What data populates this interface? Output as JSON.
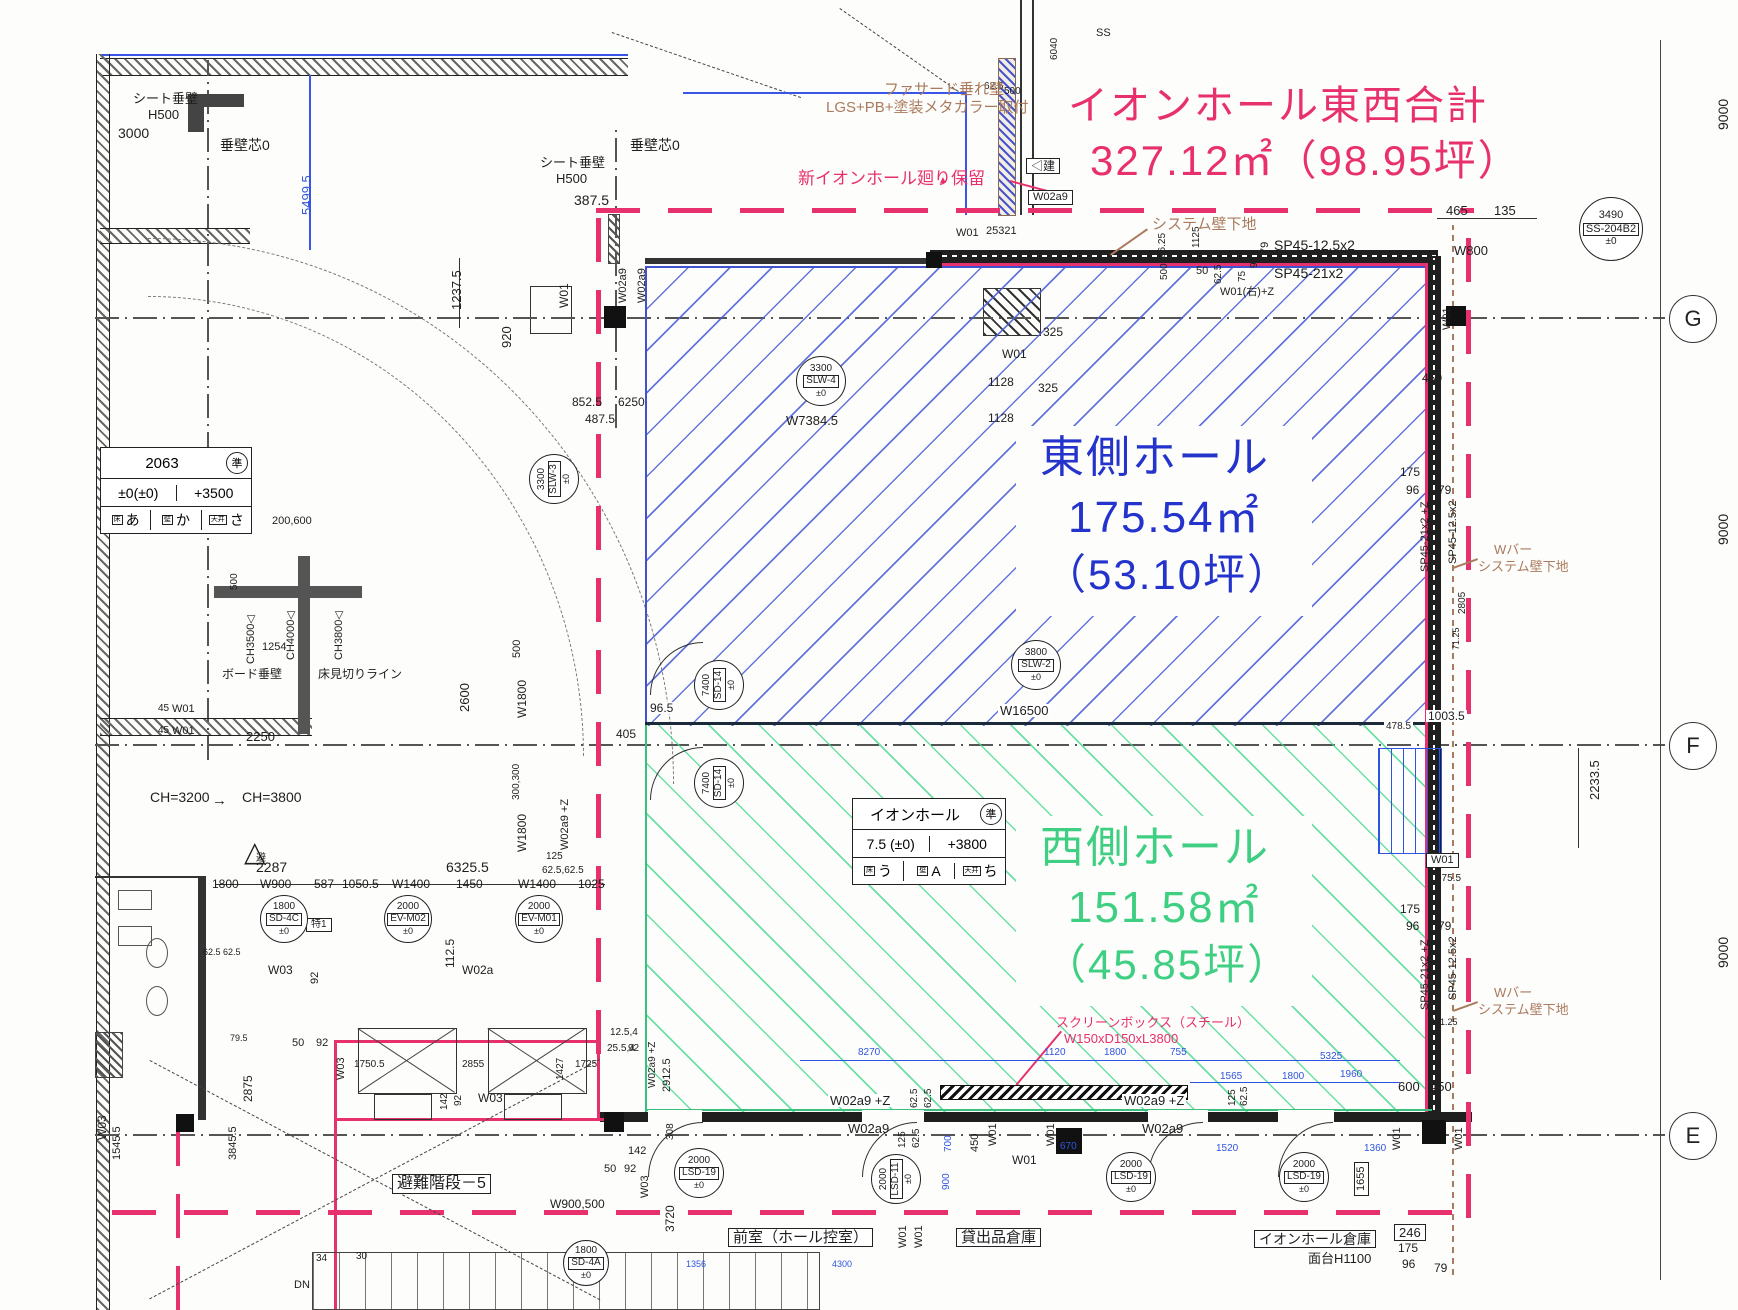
{
  "colors": {
    "boundary_pink": "#e8306e",
    "east_blue": "#2433cc",
    "west_green": "#3ecf82",
    "note_brown": "#aa7a5e",
    "dim_blue": "#2f55e0"
  },
  "title": {
    "line1": "イオンホール東西合計",
    "line2": "327.12㎡（98.95坪）"
  },
  "east_hall": {
    "name": "東側ホール",
    "area": "175.54㎡",
    "tsubo": "（53.10坪）"
  },
  "west_hall": {
    "name": "西側ホール",
    "area": "151.58㎡",
    "tsubo": "（45.85坪）"
  },
  "grid": {
    "marks": [
      [
        "G",
        318
      ],
      [
        "F",
        745
      ],
      [
        "E",
        1135
      ]
    ],
    "span_label": "9000"
  },
  "room_tags": [
    [
      820,
      380,
      24,
      "3300",
      "SLW-4",
      "±0",
      0
    ],
    [
      553,
      478,
      24,
      "3300",
      "SLW-3",
      "±0",
      -90
    ],
    [
      1035,
      664,
      24,
      "3800",
      "SLW-2",
      "±0",
      0
    ],
    [
      718,
      684,
      24,
      "7400",
      "SD-14",
      "±0",
      -90
    ],
    [
      718,
      782,
      24,
      "7400",
      "SD-14",
      "±0",
      -90
    ],
    [
      283,
      918,
      23,
      "1800",
      "SD-4C",
      "±0",
      0
    ],
    [
      407,
      918,
      23,
      "2000",
      "EV-M02",
      "±0",
      0
    ],
    [
      538,
      918,
      23,
      "2000",
      "EV-M01",
      "±0",
      0
    ],
    [
      698,
      1172,
      24,
      "2000",
      "LSD-19",
      "±0",
      0
    ],
    [
      895,
      1178,
      24,
      "2000",
      "LSD-11",
      "±0",
      -90
    ],
    [
      1130,
      1176,
      24,
      "2000",
      "LSD-19",
      "±0",
      0
    ],
    [
      1303,
      1176,
      24,
      "2000",
      "LSD-19",
      "±0",
      0
    ],
    [
      585,
      1262,
      22,
      "1800",
      "SD-4A",
      "±0",
      0
    ],
    [
      1610,
      228,
      31,
      "3490",
      "SS-204B2",
      "±0",
      0
    ]
  ],
  "stamp_tables": [
    {
      "x": 100,
      "y": 447,
      "w": 150,
      "title": "2063",
      "stamp": "準",
      "levels": [
        "±0(±0)",
        "+3500"
      ],
      "finishes": [
        [
          "床",
          "あ"
        ],
        [
          "壁",
          "か"
        ],
        [
          "天井",
          "さ"
        ]
      ]
    },
    {
      "x": 852,
      "y": 798,
      "w": 152,
      "title": "イオンホール",
      "stamp": "準",
      "levels": [
        "7.5 (±0)",
        "+3800"
      ],
      "finishes": [
        [
          "床",
          "う"
        ],
        [
          "壁",
          "A"
        ],
        [
          "天井",
          "ち"
        ]
      ]
    }
  ],
  "labels": [
    [
      "シート垂壁",
      133,
      92,
      13
    ],
    [
      "H500",
      148,
      108,
      13
    ],
    [
      "3000",
      118,
      126,
      14
    ],
    [
      "垂壁芯0",
      220,
      138,
      14
    ],
    [
      "5499.5",
      300,
      215,
      13,
      "b",
      -90
    ],
    [
      "シート垂壁",
      540,
      156,
      13
    ],
    [
      "H500",
      556,
      172,
      13
    ],
    [
      "垂壁芯0",
      630,
      138,
      14
    ],
    [
      "387.5",
      574,
      193,
      14
    ],
    [
      "1237.5",
      450,
      310,
      13,
      "k",
      -90
    ],
    [
      "920",
      500,
      348,
      13,
      "k",
      -90
    ],
    [
      "W01",
      558,
      308,
      12,
      "k",
      -90
    ],
    [
      "W02a9",
      618,
      303,
      11,
      "k",
      -90
    ],
    [
      "W02a9",
      637,
      303,
      11,
      "k",
      -90
    ],
    [
      "852.5",
      572,
      396,
      12
    ],
    [
      "6250",
      618,
      396,
      12
    ],
    [
      "487.5",
      585,
      413,
      12
    ],
    [
      "W7384.5",
      786,
      414,
      13
    ],
    [
      "1128",
      988,
      376,
      12
    ],
    [
      "1128",
      988,
      412,
      12
    ],
    [
      "325",
      1043,
      326,
      12
    ],
    [
      "325",
      1038,
      382,
      12
    ],
    [
      "W01",
      1002,
      348,
      12
    ],
    [
      "W01",
      956,
      228,
      11
    ],
    [
      "25321",
      986,
      226,
      11
    ],
    [
      "62.5",
      984,
      82,
      10
    ],
    [
      "500",
      1004,
      87,
      10
    ],
    [
      "6040",
      1050,
      60,
      10,
      "k",
      -90
    ],
    [
      "SS",
      1096,
      28,
      11
    ],
    [
      "1125",
      1192,
      248,
      10,
      "k",
      -90
    ],
    [
      "96.25",
      1158,
      258,
      10,
      "k",
      -90
    ],
    [
      "500",
      1160,
      280,
      10,
      "k",
      -90
    ],
    [
      "50",
      1196,
      266,
      11
    ],
    [
      "62.5",
      1214,
      284,
      10,
      "k",
      -90
    ],
    [
      "75",
      1238,
      282,
      10,
      "k",
      -90
    ],
    [
      "96",
      1250,
      268,
      10,
      "k",
      -90
    ],
    [
      "79",
      1260,
      254,
      11,
      "k",
      -90
    ],
    [
      "SP45-12.5x2",
      1274,
      238,
      14
    ],
    [
      "SP45-21x2",
      1274,
      266,
      14
    ],
    [
      "W01(右)+Z",
      1220,
      287,
      11
    ],
    [
      "465",
      1446,
      204,
      13
    ],
    [
      "135",
      1494,
      204,
      13
    ],
    [
      "W800",
      1454,
      244,
      13
    ],
    [
      "W01",
      1442,
      330,
      11,
      "k",
      -90
    ],
    [
      "450",
      1422,
      372,
      12
    ],
    [
      "175",
      1400,
      466,
      12
    ],
    [
      "96",
      1406,
      484,
      12
    ],
    [
      "79",
      1438,
      484,
      12
    ],
    [
      "SP45-21x2 +Z",
      1420,
      572,
      11,
      "k",
      -90
    ],
    [
      "SP45-12.5x2",
      1448,
      564,
      11,
      "k",
      -90
    ],
    [
      "2805",
      1458,
      614,
      10,
      "k",
      -90
    ],
    [
      "71.25",
      1452,
      650,
      9,
      "k",
      -90
    ],
    [
      "1003.5",
      1426,
      710,
      12,
      "k",
      0,
      "bg"
    ],
    [
      "478.5",
      1384,
      722,
      10,
      "k",
      0,
      "bg"
    ],
    [
      "2233.5",
      1588,
      800,
      13,
      "k",
      -90
    ],
    [
      "W01",
      1426,
      853,
      11,
      "k",
      0,
      "box"
    ],
    [
      "975.5",
      1436,
      874,
      10
    ],
    [
      "175",
      1400,
      903,
      12
    ],
    [
      "96",
      1406,
      920,
      12
    ],
    [
      "79",
      1438,
      920,
      12
    ],
    [
      "SP45-21x2 +Z",
      1420,
      1010,
      11,
      "k",
      -90
    ],
    [
      "SP45-12.5x2",
      1448,
      1000,
      11,
      "k",
      -90
    ],
    [
      "471.25",
      1430,
      1018,
      9
    ],
    [
      "W16500",
      998,
      704,
      13,
      "k",
      0,
      "bg"
    ],
    [
      "96.5",
      648,
      702,
      12,
      "k",
      0,
      "bg"
    ],
    [
      "405",
      616,
      728,
      12
    ],
    [
      "2250",
      246,
      730,
      13
    ],
    [
      "45",
      158,
      704,
      10
    ],
    [
      "45",
      158,
      726,
      10
    ],
    [
      "W01",
      172,
      704,
      11
    ],
    [
      "W01",
      172,
      726,
      11
    ],
    [
      "200,600",
      272,
      516,
      11
    ],
    [
      "CH3500◁",
      246,
      664,
      11,
      "k",
      -90
    ],
    [
      "CH4000◁",
      286,
      660,
      11,
      "k",
      -90
    ],
    [
      "CH3800◁",
      334,
      660,
      11,
      "k",
      -90
    ],
    [
      "500",
      230,
      590,
      10,
      "k",
      -90
    ],
    [
      "1254",
      262,
      642,
      11
    ],
    [
      "ボード垂壁",
      222,
      668,
      12
    ],
    [
      "床見切りライン",
      318,
      668,
      12
    ],
    [
      "2600",
      458,
      712,
      13,
      "k",
      -90
    ],
    [
      "500",
      512,
      658,
      11,
      "k",
      -90
    ],
    [
      "W1800",
      516,
      718,
      12,
      "k",
      -90
    ],
    [
      "300,300",
      512,
      800,
      10,
      "k",
      -90
    ],
    [
      "W1800",
      516,
      852,
      12,
      "k",
      -90
    ],
    [
      "CH=3200",
      150,
      790,
      14
    ],
    [
      "CH=3800",
      242,
      790,
      14
    ],
    [
      "→",
      212,
      793,
      15
    ],
    [
      "2287",
      256,
      860,
      14
    ],
    [
      "6325.5",
      446,
      860,
      14
    ],
    [
      "1800",
      212,
      878,
      12
    ],
    [
      "W900",
      260,
      878,
      12
    ],
    [
      "587",
      314,
      878,
      12
    ],
    [
      "1050.5",
      342,
      878,
      12
    ],
    [
      "W1400",
      392,
      878,
      12
    ],
    [
      "1450",
      456,
      878,
      12
    ],
    [
      "W1400",
      518,
      878,
      12
    ],
    [
      "1025",
      578,
      878,
      12
    ],
    [
      "W02a9 +Z",
      560,
      850,
      11,
      "k",
      -90
    ],
    [
      "125",
      546,
      852,
      10
    ],
    [
      "62.5,62.5",
      542,
      866,
      10
    ],
    [
      "特1",
      306,
      918,
      10,
      "k",
      0,
      "box"
    ],
    [
      "W03",
      268,
      964,
      12
    ],
    [
      "92",
      310,
      984,
      11,
      "k",
      -90
    ],
    [
      "112.5",
      444,
      968,
      12,
      "k",
      -90
    ],
    [
      "W02a",
      462,
      964,
      12
    ],
    [
      "62.5 62.5",
      203,
      948,
      9
    ],
    [
      "12.5,4",
      610,
      1028,
      10
    ],
    [
      "25.5,4",
      607,
      1044,
      10
    ],
    [
      "92",
      628,
      1044,
      10
    ],
    [
      "2912.5",
      662,
      1092,
      11,
      "k",
      -90
    ],
    [
      "W02a9 +Z",
      648,
      1088,
      10,
      "k",
      -90
    ],
    [
      "2875",
      242,
      1102,
      12,
      "k",
      -90
    ],
    [
      "79.5",
      230,
      1034,
      9
    ],
    [
      "W03",
      96,
      1140,
      12,
      "k",
      -90
    ],
    [
      "1750.5",
      354,
      1060,
      10
    ],
    [
      "2855",
      462,
      1060,
      10
    ],
    [
      "1427",
      556,
      1080,
      10,
      "k",
      -90
    ],
    [
      "1725",
      575,
      1060,
      10
    ],
    [
      "142",
      440,
      1110,
      10,
      "k",
      -90
    ],
    [
      "92",
      454,
      1106,
      10,
      "k",
      -90
    ],
    [
      "W03",
      478,
      1092,
      12
    ],
    [
      "50",
      292,
      1038,
      11
    ],
    [
      "92",
      316,
      1038,
      11
    ],
    [
      "W03",
      336,
      1080,
      11,
      "k",
      -90
    ],
    [
      "142",
      628,
      1146,
      11
    ],
    [
      "50",
      604,
      1164,
      11
    ],
    [
      "92",
      624,
      1164,
      11
    ],
    [
      "W03",
      640,
      1198,
      11,
      "k",
      -90
    ],
    [
      "308",
      666,
      1140,
      10,
      "k",
      -90
    ],
    [
      "3845.5",
      228,
      1160,
      11,
      "k",
      -90
    ],
    [
      "1545.5",
      112,
      1160,
      11,
      "k",
      -90
    ],
    [
      "34",
      316,
      1254,
      10
    ],
    [
      "30",
      356,
      1252,
      10
    ],
    [
      "DN",
      294,
      1280,
      11
    ],
    [
      "W900,500",
      550,
      1198,
      12
    ],
    [
      "3720",
      664,
      1232,
      12,
      "k",
      -90
    ],
    [
      "W02a9 +Z",
      828,
      1094,
      13,
      "k",
      0,
      "bg"
    ],
    [
      "62.5",
      910,
      1108,
      10,
      "k",
      -90
    ],
    [
      "62.5",
      924,
      1108,
      10,
      "k",
      -90
    ],
    [
      "W02a9",
      848,
      1122,
      13
    ],
    [
      "125",
      898,
      1148,
      10,
      "k",
      -90
    ],
    [
      "62.5",
      912,
      1148,
      10,
      "k",
      -90
    ],
    [
      "W02a9 +Z",
      1122,
      1094,
      13,
      "k",
      0,
      "bg"
    ],
    [
      "W02a9",
      1142,
      1122,
      13
    ],
    [
      "125",
      1228,
      1106,
      10,
      "k",
      -90
    ],
    [
      "62.5",
      1240,
      1106,
      10,
      "k",
      -90
    ],
    [
      "8270",
      858,
      1048,
      10,
      "b"
    ],
    [
      "1120",
      1044,
      1048,
      10,
      "b"
    ],
    [
      "1800",
      1104,
      1048,
      10,
      "b"
    ],
    [
      "755",
      1170,
      1048,
      10,
      "b"
    ],
    [
      "5325",
      1320,
      1052,
      10,
      "b"
    ],
    [
      "1565",
      1220,
      1072,
      10,
      "b"
    ],
    [
      "1800",
      1282,
      1072,
      10,
      "b"
    ],
    [
      "1960",
      1340,
      1070,
      10,
      "b"
    ],
    [
      "1520",
      1216,
      1144,
      10,
      "b"
    ],
    [
      "1360",
      1364,
      1144,
      10,
      "b"
    ],
    [
      "670",
      1060,
      1142,
      10,
      "b"
    ],
    [
      "700",
      944,
      1152,
      10,
      "b",
      -90
    ],
    [
      "900",
      942,
      1190,
      10,
      "b",
      -90
    ],
    [
      "1356",
      686,
      1260,
      9,
      "b"
    ],
    [
      "4300",
      832,
      1260,
      9,
      "b"
    ],
    [
      "600",
      1398,
      1080,
      13
    ],
    [
      "450",
      1430,
      1080,
      13
    ],
    [
      "W01",
      1392,
      1150,
      11,
      "k",
      -90
    ],
    [
      "W01",
      1454,
      1150,
      11,
      "k",
      -90
    ],
    [
      "450",
      970,
      1152,
      11,
      "k",
      -90
    ],
    [
      "W01",
      988,
      1146,
      11,
      "k",
      -90
    ],
    [
      "W01",
      1046,
      1146,
      11,
      "k",
      -90
    ],
    [
      "W01",
      1010,
      1154,
      12,
      "k",
      0,
      "bg"
    ],
    [
      "1655",
      1354,
      1196,
      11,
      "k",
      -90,
      "box"
    ],
    [
      "246",
      1394,
      1224,
      13,
      "k",
      0,
      "box"
    ],
    [
      "175",
      1398,
      1242,
      12
    ],
    [
      "96",
      1402,
      1258,
      12
    ],
    [
      "79",
      1434,
      1262,
      12
    ],
    [
      "スクリーンボックス（スチール）",
      1056,
      1016,
      13,
      "m"
    ],
    [
      "W150xD150xL3800",
      1064,
      1032,
      13,
      "m"
    ],
    [
      "前室（ホール控室）",
      728,
      1228,
      15,
      "k",
      0,
      "box"
    ],
    [
      "貸出品倉庫",
      956,
      1228,
      15,
      "k",
      0,
      "box"
    ],
    [
      "イオンホール倉庫",
      1254,
      1230,
      14,
      "k",
      0,
      "box"
    ],
    [
      "面台H1100",
      1308,
      1252,
      13
    ],
    [
      "W01",
      898,
      1248,
      11,
      "k",
      -90
    ],
    [
      "W01",
      914,
      1248,
      11,
      "k",
      -90
    ],
    [
      "避難階段－5",
      392,
      1174,
      16,
      "k",
      0,
      "box"
    ],
    [
      "ファサード垂れ壁",
      884,
      82,
      15,
      "br"
    ],
    [
      "LGS+PB+塗装メタカラー取付",
      826,
      100,
      15,
      "br"
    ],
    [
      "システム壁下地",
      1152,
      217,
      15,
      "br"
    ],
    [
      "Wバー",
      1494,
      543,
      13,
      "br"
    ],
    [
      "システム壁下地",
      1478,
      560,
      13,
      "br"
    ],
    [
      "Wバー",
      1494,
      986,
      13,
      "br"
    ],
    [
      "システム壁下地",
      1478,
      1003,
      13,
      "br"
    ],
    [
      "新イオンホール廻り保留",
      798,
      170,
      17,
      "m"
    ],
    [
      "▲",
      938,
      176,
      10,
      "m"
    ],
    [
      "△",
      244,
      838,
      28
    ],
    [
      "避",
      256,
      854,
      10
    ],
    [
      "9000",
      1716,
      130,
      14,
      "k",
      -90
    ],
    [
      "9000",
      1716,
      545,
      14,
      "k",
      -90
    ],
    [
      "9000",
      1716,
      968,
      14,
      "k",
      -90
    ],
    [
      "◁建",
      1026,
      158,
      12,
      "k",
      0,
      "box"
    ],
    [
      "W02a9",
      1028,
      190,
      11,
      "k",
      0,
      "box"
    ]
  ]
}
